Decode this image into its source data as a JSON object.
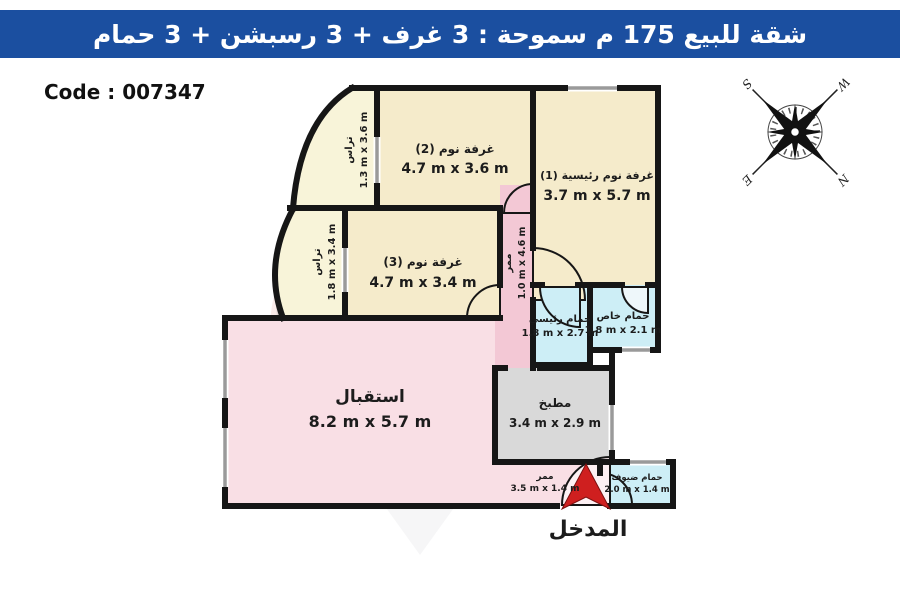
{
  "header": {
    "title": "شقة للبيع 175 م سموحة :  3 غرف + 3 رسبشن + 3 حمام",
    "bg_color": "#1b4fa0"
  },
  "code_label": "Code : 007347",
  "entrance_label": "المدخل",
  "compass": {
    "n": "N",
    "s": "S",
    "e": "E",
    "w": "W"
  },
  "watermark": {
    "line1": "RE/MAX",
    "line2": "AVALON"
  },
  "rooms": {
    "bedroom2": {
      "name": "غرفة نوم (2)",
      "dims": "4.7 m x 3.6 m"
    },
    "master_bedroom": {
      "name": "غرفة نوم رئيسية (1)",
      "dims": "3.7 m x 5.7 m"
    },
    "bedroom3": {
      "name": "غرفة نوم (3)",
      "dims": "4.7 m x 3.4 m"
    },
    "terrace1": {
      "name": "تراس",
      "dims": "1.3 m x 3.6 m"
    },
    "terrace2": {
      "name": "تراس",
      "dims": "1.8 m x 3.4 m"
    },
    "hallway1": {
      "name": "ممر",
      "dims": "1.0 m x 4.6 m"
    },
    "main_bathroom": {
      "name": "حمام رئيسي",
      "dims": "1.8 m x 2.7 m"
    },
    "private_bathroom": {
      "name": "حمام خاص",
      "dims": "1.8 m x 2.1 m"
    },
    "reception": {
      "name": "استقبال",
      "dims": "8.2 m x 5.7 m"
    },
    "kitchen": {
      "name": "مطبخ",
      "dims": "3.4 m x 2.9 m"
    },
    "hallway2": {
      "name": "ممر",
      "dims": "3.5 m x 1.4 m"
    },
    "guest_bathroom": {
      "name": "حمام ضيوف",
      "dims": "2.0 m x 1.4 m"
    }
  },
  "colors": {
    "wall": "#161616",
    "bedroom_fill": "#f5ebcb",
    "terrace_fill": "#f8f4d9",
    "reception_fill": "#f9dfe5",
    "corridor_fill": "#f3c8d5",
    "bathroom_fill": "#cdeef6",
    "kitchen_fill": "#d9d9d9",
    "window": "#9a9a9a",
    "entrance_arrow": "#cf1f1f"
  }
}
